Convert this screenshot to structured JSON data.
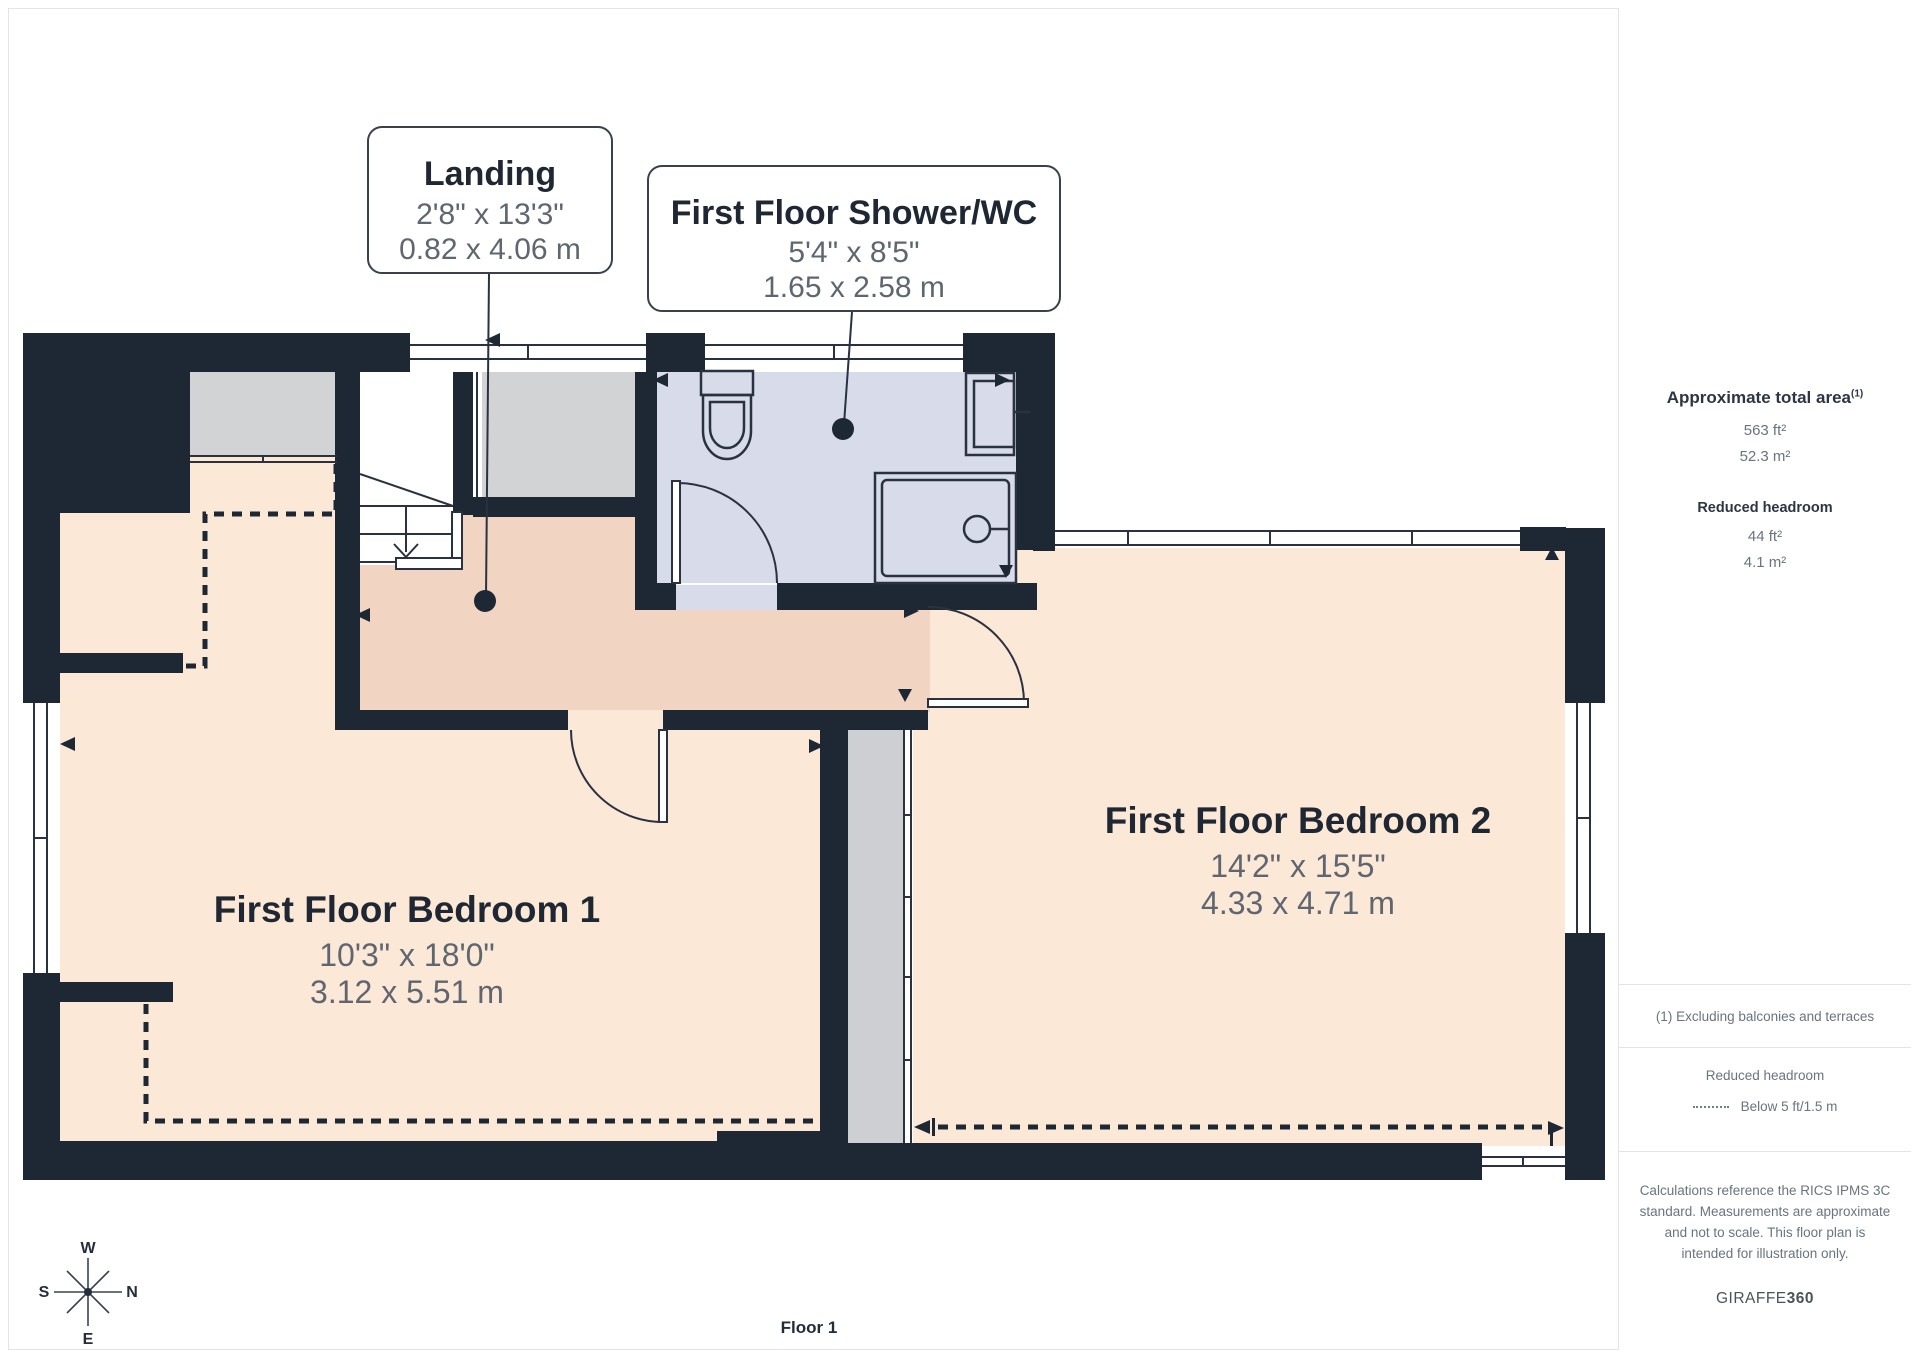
{
  "plan": {
    "floor_label": "Floor 1",
    "rooms": [
      {
        "id": "landing",
        "name": "Landing",
        "dims_imperial": "2'8\" x 13'3\"",
        "dims_metric": "0.82 x 4.06 m"
      },
      {
        "id": "shower-wc",
        "name": "First Floor Shower/WC",
        "dims_imperial": "5'4\" x 8'5\"",
        "dims_metric": "1.65 x 2.58 m"
      },
      {
        "id": "bedroom-1",
        "name": "First Floor Bedroom 1",
        "dims_imperial": "10'3\" x 18'0\"",
        "dims_metric": "3.12 x 5.51 m"
      },
      {
        "id": "bedroom-2",
        "name": "First Floor Bedroom 2",
        "dims_imperial": "14'2\" x 15'5\"",
        "dims_metric": "4.33 x 4.71 m"
      }
    ],
    "fixtures": [
      "stairs",
      "toilet",
      "sink",
      "shower-tray"
    ],
    "compass": {
      "top": "W",
      "left": "S",
      "right": "N",
      "bottom": "E"
    }
  },
  "sidebar": {
    "area_title": "Approximate total area",
    "area_superscript": "(1)",
    "area_ft": "563 ft²",
    "area_m": "52.3 m²",
    "headroom_title": "Reduced headroom",
    "headroom_ft": "44 ft²",
    "headroom_m": "4.1 m²",
    "note": "(1) Excluding balconies and terraces",
    "legend_title": "Reduced headroom",
    "legend_value": "Below 5 ft/1.5 m",
    "disclaimer": "Calculations reference the RICS IPMS 3C standard. Measurements are approximate and not to scale. This floor plan is intended for illustration only.",
    "brand_name": "GIRAFFE",
    "brand_suffix": "360"
  },
  "colors": {
    "wall": "#1e2734",
    "bedroom_floor": "#fbe8d7",
    "landing_floor": "#f2d4c2",
    "bathroom_floor": "#d8dcea",
    "storage_grey": "#d2d3d5",
    "dim_text": "#5f6670",
    "title_text": "#1f2733"
  }
}
